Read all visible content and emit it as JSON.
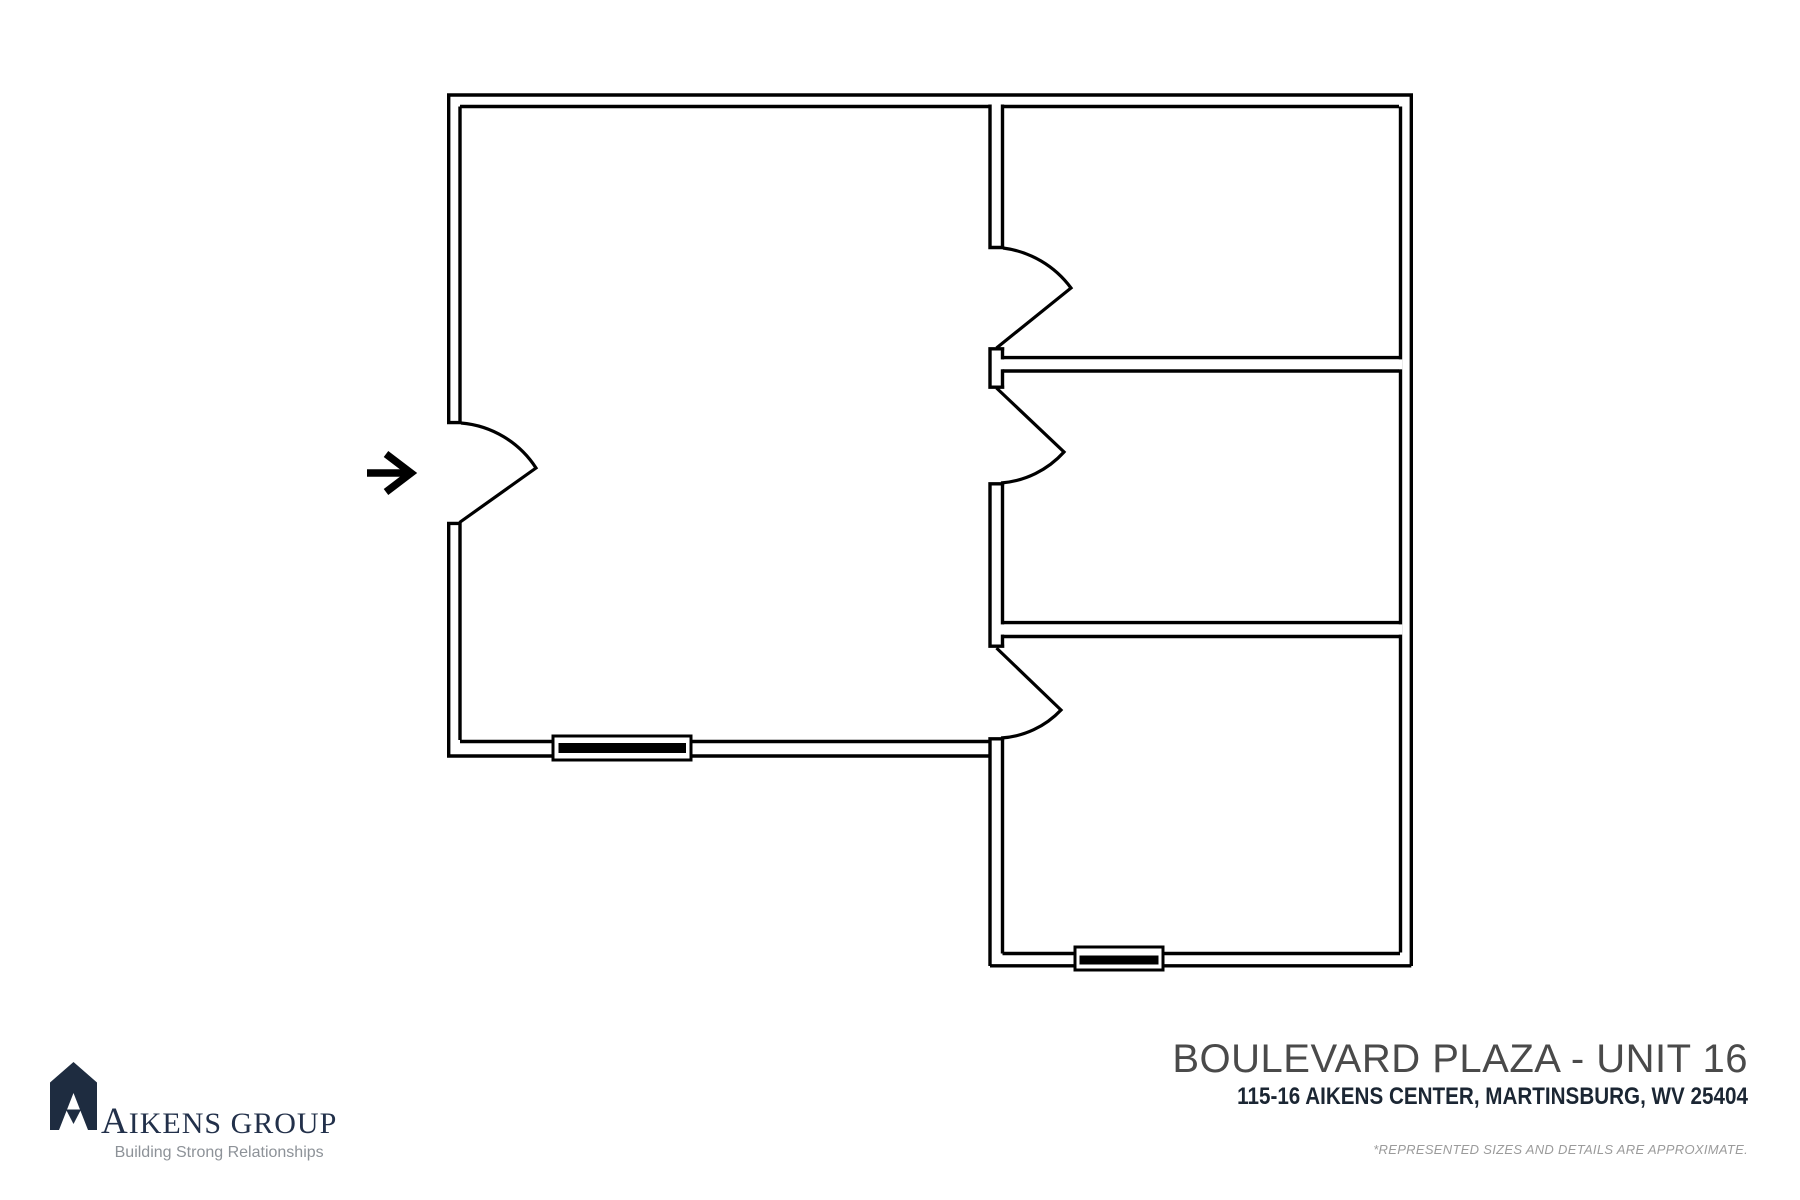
{
  "page": {
    "width": 1800,
    "height": 1200,
    "background": "#ffffff"
  },
  "floor_plan": {
    "description": "Unit 16 floor plan: one large open room with entry door on the left, three rooms stacked along the right side, four door swings and two windows",
    "line_color": "#000000",
    "door_count": 4,
    "window_count": 2,
    "entry_arrow_icon": "right-arrow"
  },
  "title_block": {
    "title": "BOULEVARD PLAZA - UNIT 16",
    "address": "115-16 AIKENS CENTER, MARTINSBURG, WV 25404",
    "disclaimer": "*REPRESENTED SIZES AND DETAILS ARE APPROXIMATE.",
    "title_color": "#4a4a4a",
    "address_color": "#1b2633",
    "disclaimer_color": "#9b9b9b"
  },
  "logo": {
    "name": "AIKENS GROUP",
    "tagline": "Building Strong Relationships",
    "mark_color": "#1e2c40",
    "name_color": "#22304a",
    "tagline_color": "#8d9298"
  }
}
